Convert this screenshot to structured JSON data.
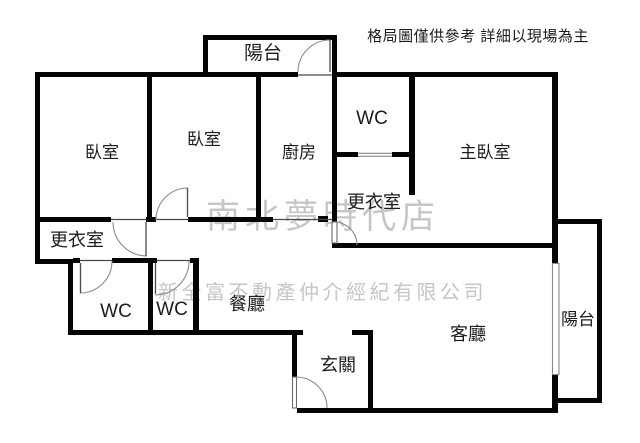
{
  "disclaimer": "格局圖僅供參考 詳細以現場為主",
  "watermarks": {
    "store_name": "南北夢時代店",
    "company_name": "新全富不動產仲介經紀有限公司"
  },
  "rooms": {
    "balcony_top": "陽台",
    "bedroom_left": "臥室",
    "bedroom_middle": "臥室",
    "kitchen": "廚房",
    "wc_top": "WC",
    "master_bedroom": "主臥室",
    "walkin_closet_right": "更衣室",
    "walkin_closet_left": "更衣室",
    "wc_bottom_left": "WC",
    "wc_bottom_middle": "WC",
    "dining_room": "餐廳",
    "entryway": "玄關",
    "living_room": "客廳",
    "balcony_right": "陽台"
  },
  "colors": {
    "background": "#ffffff",
    "wall": "#050505",
    "label": "#1c1c1c",
    "watermark": "#c6c6c6",
    "line": "#4a4a4a",
    "arc": "#8a8a8a"
  }
}
